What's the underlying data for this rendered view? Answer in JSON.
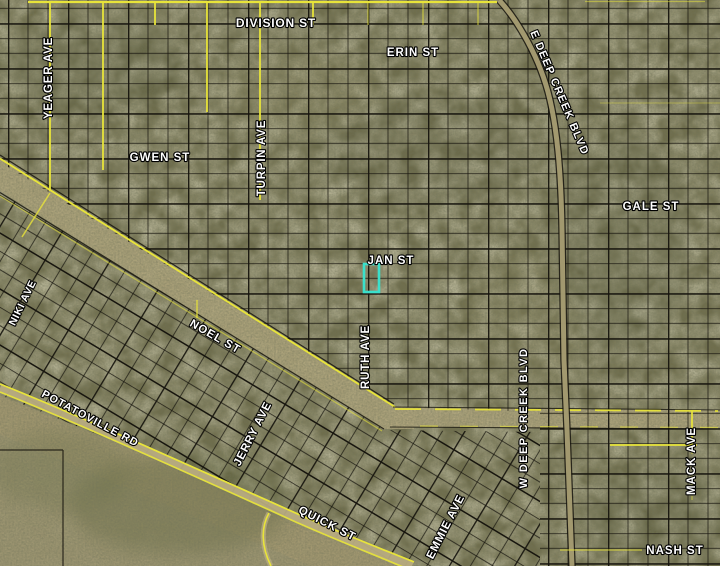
{
  "map": {
    "description": "Aerial parcel map with platted subdivision grid and highlighted parcel",
    "colors": {
      "background": "#75734f",
      "parcel_line": "#17150e",
      "street_yellow": "#e8e43a",
      "road_surface": "#b2a77e",
      "highlight": "#3ae0cb",
      "label_fill": "#ffffff",
      "label_outline": "#000000"
    },
    "selected_parcel": {
      "x": 364,
      "y": 264,
      "width": 15,
      "height": 28,
      "stroke_width": 2.6
    },
    "street_labels": [
      {
        "id": "division-st",
        "text": "DIVISION ST",
        "x": 276,
        "y": 24,
        "rotate": 0,
        "size": 12,
        "spacing": 0.8
      },
      {
        "id": "erin-st",
        "text": "ERIN ST",
        "x": 413,
        "y": 53,
        "rotate": 0,
        "size": 11.5,
        "spacing": 1
      },
      {
        "id": "e-deep-creek-blvd",
        "text": "E DEEP CREEK BLVD",
        "x": 559,
        "y": 93,
        "rotate": 67,
        "size": 11,
        "spacing": 1.2
      },
      {
        "id": "yeager-ave",
        "text": "YEAGER AVE",
        "x": 49,
        "y": 78,
        "rotate": -90,
        "size": 11.5,
        "spacing": 0.8
      },
      {
        "id": "gwen-st",
        "text": "GWEN ST",
        "x": 160,
        "y": 158,
        "rotate": 0,
        "size": 11.5,
        "spacing": 1
      },
      {
        "id": "turpin-ave",
        "text": "TURPIN AVE",
        "x": 262,
        "y": 158,
        "rotate": -90,
        "size": 11.5,
        "spacing": 0.8
      },
      {
        "id": "gale-st",
        "text": "GALE ST",
        "x": 651,
        "y": 207,
        "rotate": 0,
        "size": 11.5,
        "spacing": 1
      },
      {
        "id": "jan-st",
        "text": "JAN ST",
        "x": 391,
        "y": 261,
        "rotate": 0,
        "size": 11.5,
        "spacing": 1
      },
      {
        "id": "niki-ave",
        "text": "NIKI AVE",
        "x": 23,
        "y": 303,
        "rotate": -64,
        "size": 10.5,
        "spacing": 0.6
      },
      {
        "id": "noel-st",
        "text": "NOEL ST",
        "x": 215,
        "y": 337,
        "rotate": 30,
        "size": 11.5,
        "spacing": 1
      },
      {
        "id": "ruth-ave",
        "text": "RUTH AVE",
        "x": 366,
        "y": 357,
        "rotate": -90,
        "size": 11.5,
        "spacing": 0.8
      },
      {
        "id": "w-deep-creek-blvd",
        "text": "W DEEP CREEK BLVD",
        "x": 524,
        "y": 418,
        "rotate": -90,
        "size": 11,
        "spacing": 1.4
      },
      {
        "id": "potatoville-rd",
        "text": "POTATOVILLE RD",
        "x": 90,
        "y": 419,
        "rotate": 28,
        "size": 11,
        "spacing": 1
      },
      {
        "id": "jerry-ave",
        "text": "JERRY AVE",
        "x": 253,
        "y": 434,
        "rotate": -63,
        "size": 11.5,
        "spacing": 0.8
      },
      {
        "id": "mack-ave",
        "text": "MACK AVE",
        "x": 692,
        "y": 461,
        "rotate": -90,
        "size": 11.5,
        "spacing": 1
      },
      {
        "id": "quick-st",
        "text": "QUICK ST",
        "x": 327,
        "y": 524,
        "rotate": 27,
        "size": 11.5,
        "spacing": 1
      },
      {
        "id": "emmie-ave",
        "text": "EMMIE AVE",
        "x": 446,
        "y": 527,
        "rotate": -63,
        "size": 11.5,
        "spacing": 0.8
      },
      {
        "id": "nash-st",
        "text": "NASH ST",
        "x": 675,
        "y": 551,
        "rotate": 0,
        "size": 11.5,
        "spacing": 1
      }
    ]
  }
}
